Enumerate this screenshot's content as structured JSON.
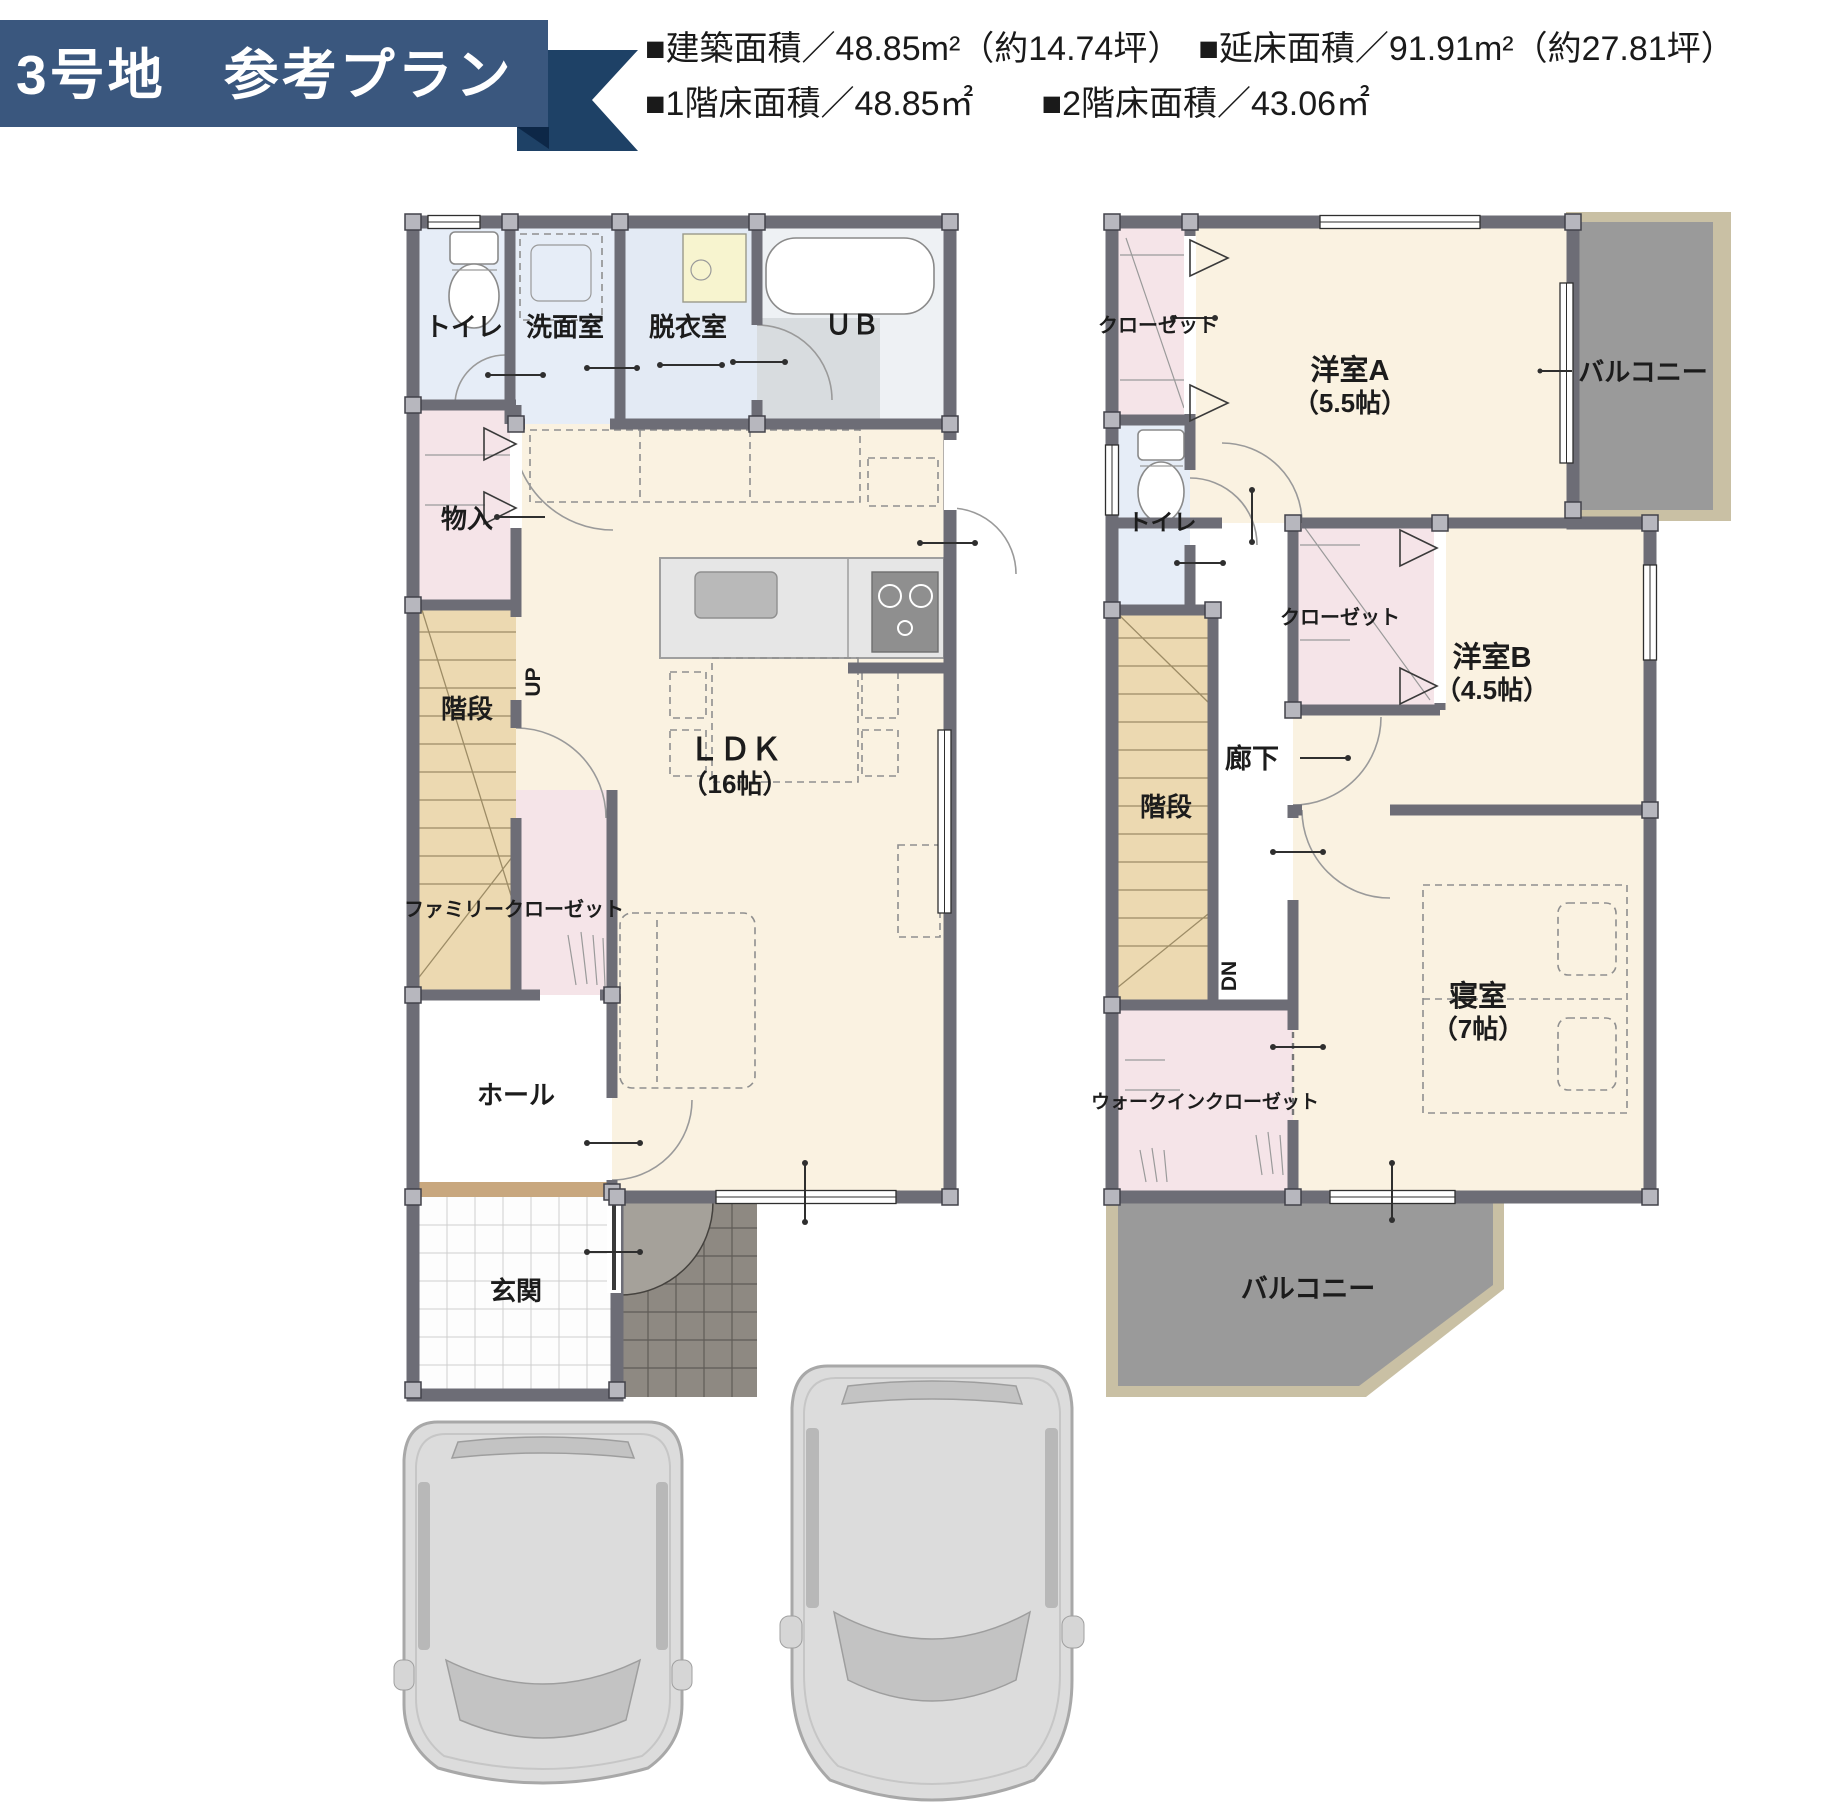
{
  "banner": {
    "title": "3号地　参考プラン"
  },
  "stats": {
    "line1": "■建築面積／48.85m²（約14.74坪）　■延床面積／91.91m²（約27.81坪）",
    "line2": "■1階床面積／48.85㎡　　■2階床面積／43.06㎡"
  },
  "floor1": {
    "toilet": "トイレ",
    "washroom": "洗面室",
    "dressing": "脱衣室",
    "bath": "ＵＢ",
    "storage": "物入",
    "stairs": "階段",
    "up": "UP",
    "family_closet": "ファミリークローゼット",
    "ldk": "ＬＤＫ",
    "ldk_size": "（16帖）",
    "hall": "ホール",
    "entrance": "玄関"
  },
  "floor2": {
    "closet_a": "クローゼット",
    "toilet": "トイレ",
    "room_a": "洋室A",
    "room_a_size": "（5.5帖）",
    "balcony_top": "バルコニー",
    "stairs": "階段",
    "dn": "DN",
    "corridor": "廊下",
    "closet_b": "クローゼット",
    "room_b": "洋室B",
    "room_b_size": "（4.5帖）",
    "bedroom": "寝室",
    "bedroom_size": "（7帖）",
    "wic": "ウォークインクローゼット",
    "balcony_bottom": "バルコニー"
  },
  "colors": {
    "banner_bg": "#3a577e",
    "banner_tail": "#1e4166",
    "banner_fold": "#0d2747",
    "wall": "#6d6d76",
    "wet_room": "#e6edf7",
    "closet_pink": "#f5e4e8",
    "stairs_tan": "#ecd9b1",
    "living_cream": "#faf2e1",
    "balcony_gray": "#9a9a9a",
    "balcony_trim": "#c9c0a4",
    "porch_gray": "#8e8982",
    "entry_step": "#c8a77e",
    "label_text": "#1c1c1c"
  }
}
